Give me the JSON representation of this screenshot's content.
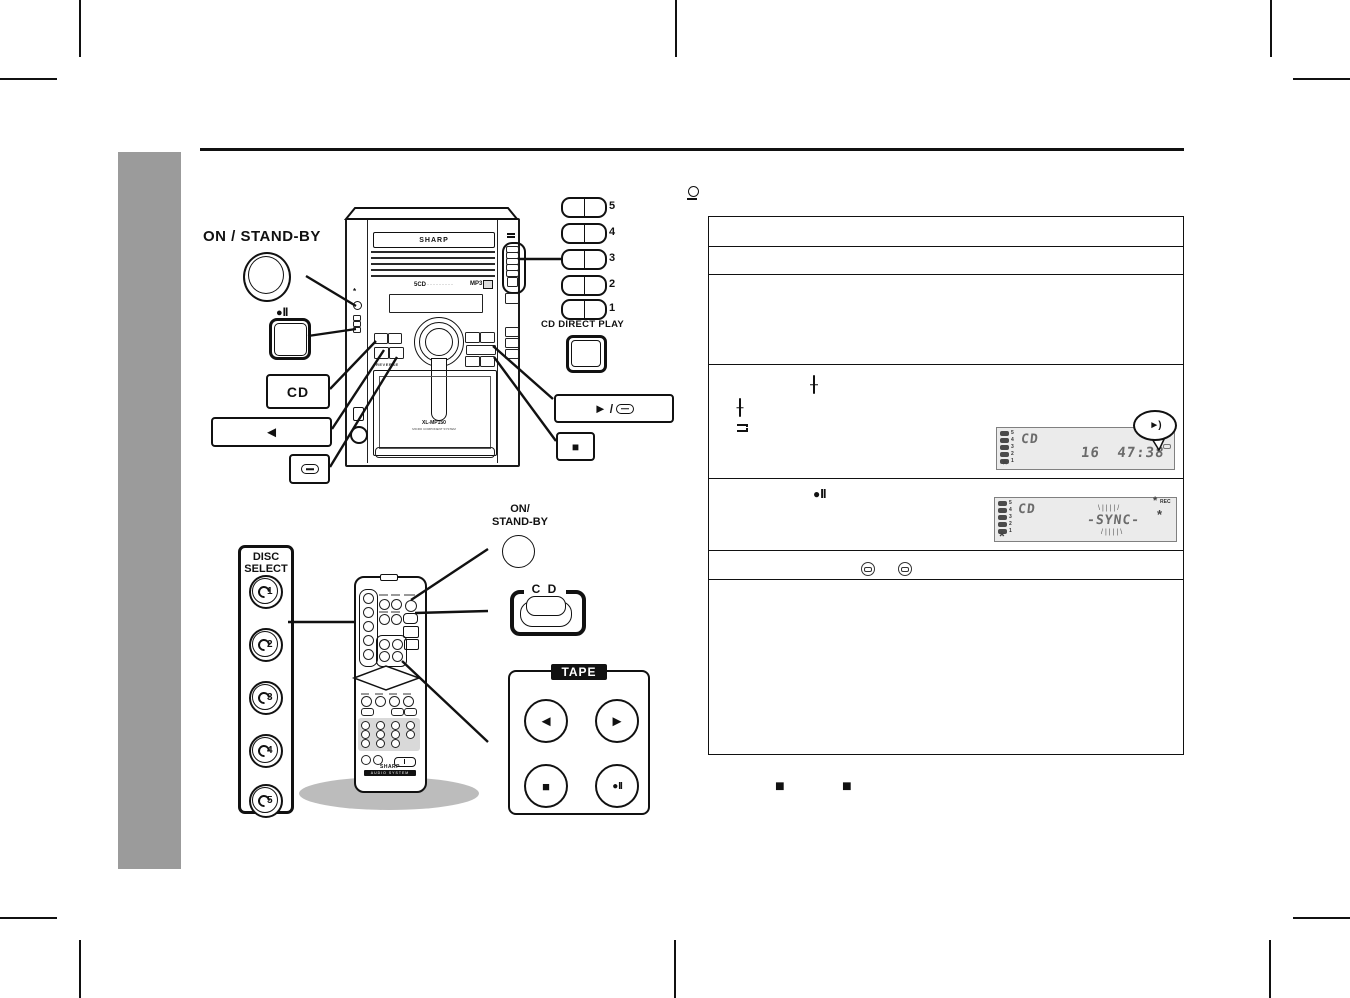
{
  "labels": {
    "on_standby_main": "ON / STAND-BY",
    "cd": "CD",
    "cd_direct_play": "CD DIRECT PLAY",
    "disc_select_line1": "DISC",
    "disc_select_line2": "SELECT",
    "on_standby_remote_line1": "ON/",
    "on_standby_remote_line2": "STAND-BY",
    "cd_remote": "C D",
    "tape": "TAPE"
  },
  "icons": {
    "play": "►",
    "rewind": "◄",
    "stop": "■",
    "rec_dot": "●",
    "pause_bars": "II",
    "slash": "/",
    "flash": "*",
    "bubble_arrow": "►)",
    "disc_numbers": [
      "1",
      "2",
      "3",
      "4",
      "5"
    ]
  },
  "unit": {
    "brand": "SHARP",
    "model": "5CD",
    "model_dots": "·········",
    "mp3": "MP3",
    "reverse": "REVERSE",
    "deck": "XL-MP150",
    "deck_sub": "MICRO COMPONENT SYSTEM"
  },
  "direct_buttons": {
    "numbers": [
      "5",
      "4",
      "3",
      "2",
      "1"
    ]
  },
  "remote": {
    "brand": "SHARP",
    "system_label": "AUDIO SYSTEM"
  },
  "lcd1": {
    "discs": [
      "5",
      "4",
      "3",
      "2",
      "1"
    ],
    "source": "CD",
    "time": "16 47:38"
  },
  "lcd2": {
    "discs": [
      "5",
      "4",
      "3",
      "2",
      "1"
    ],
    "source": "CD",
    "sync": "-SYNC-",
    "rec": "REC",
    "rays_top": "\\||||/",
    "rays_bottom": "/||||\\"
  }
}
